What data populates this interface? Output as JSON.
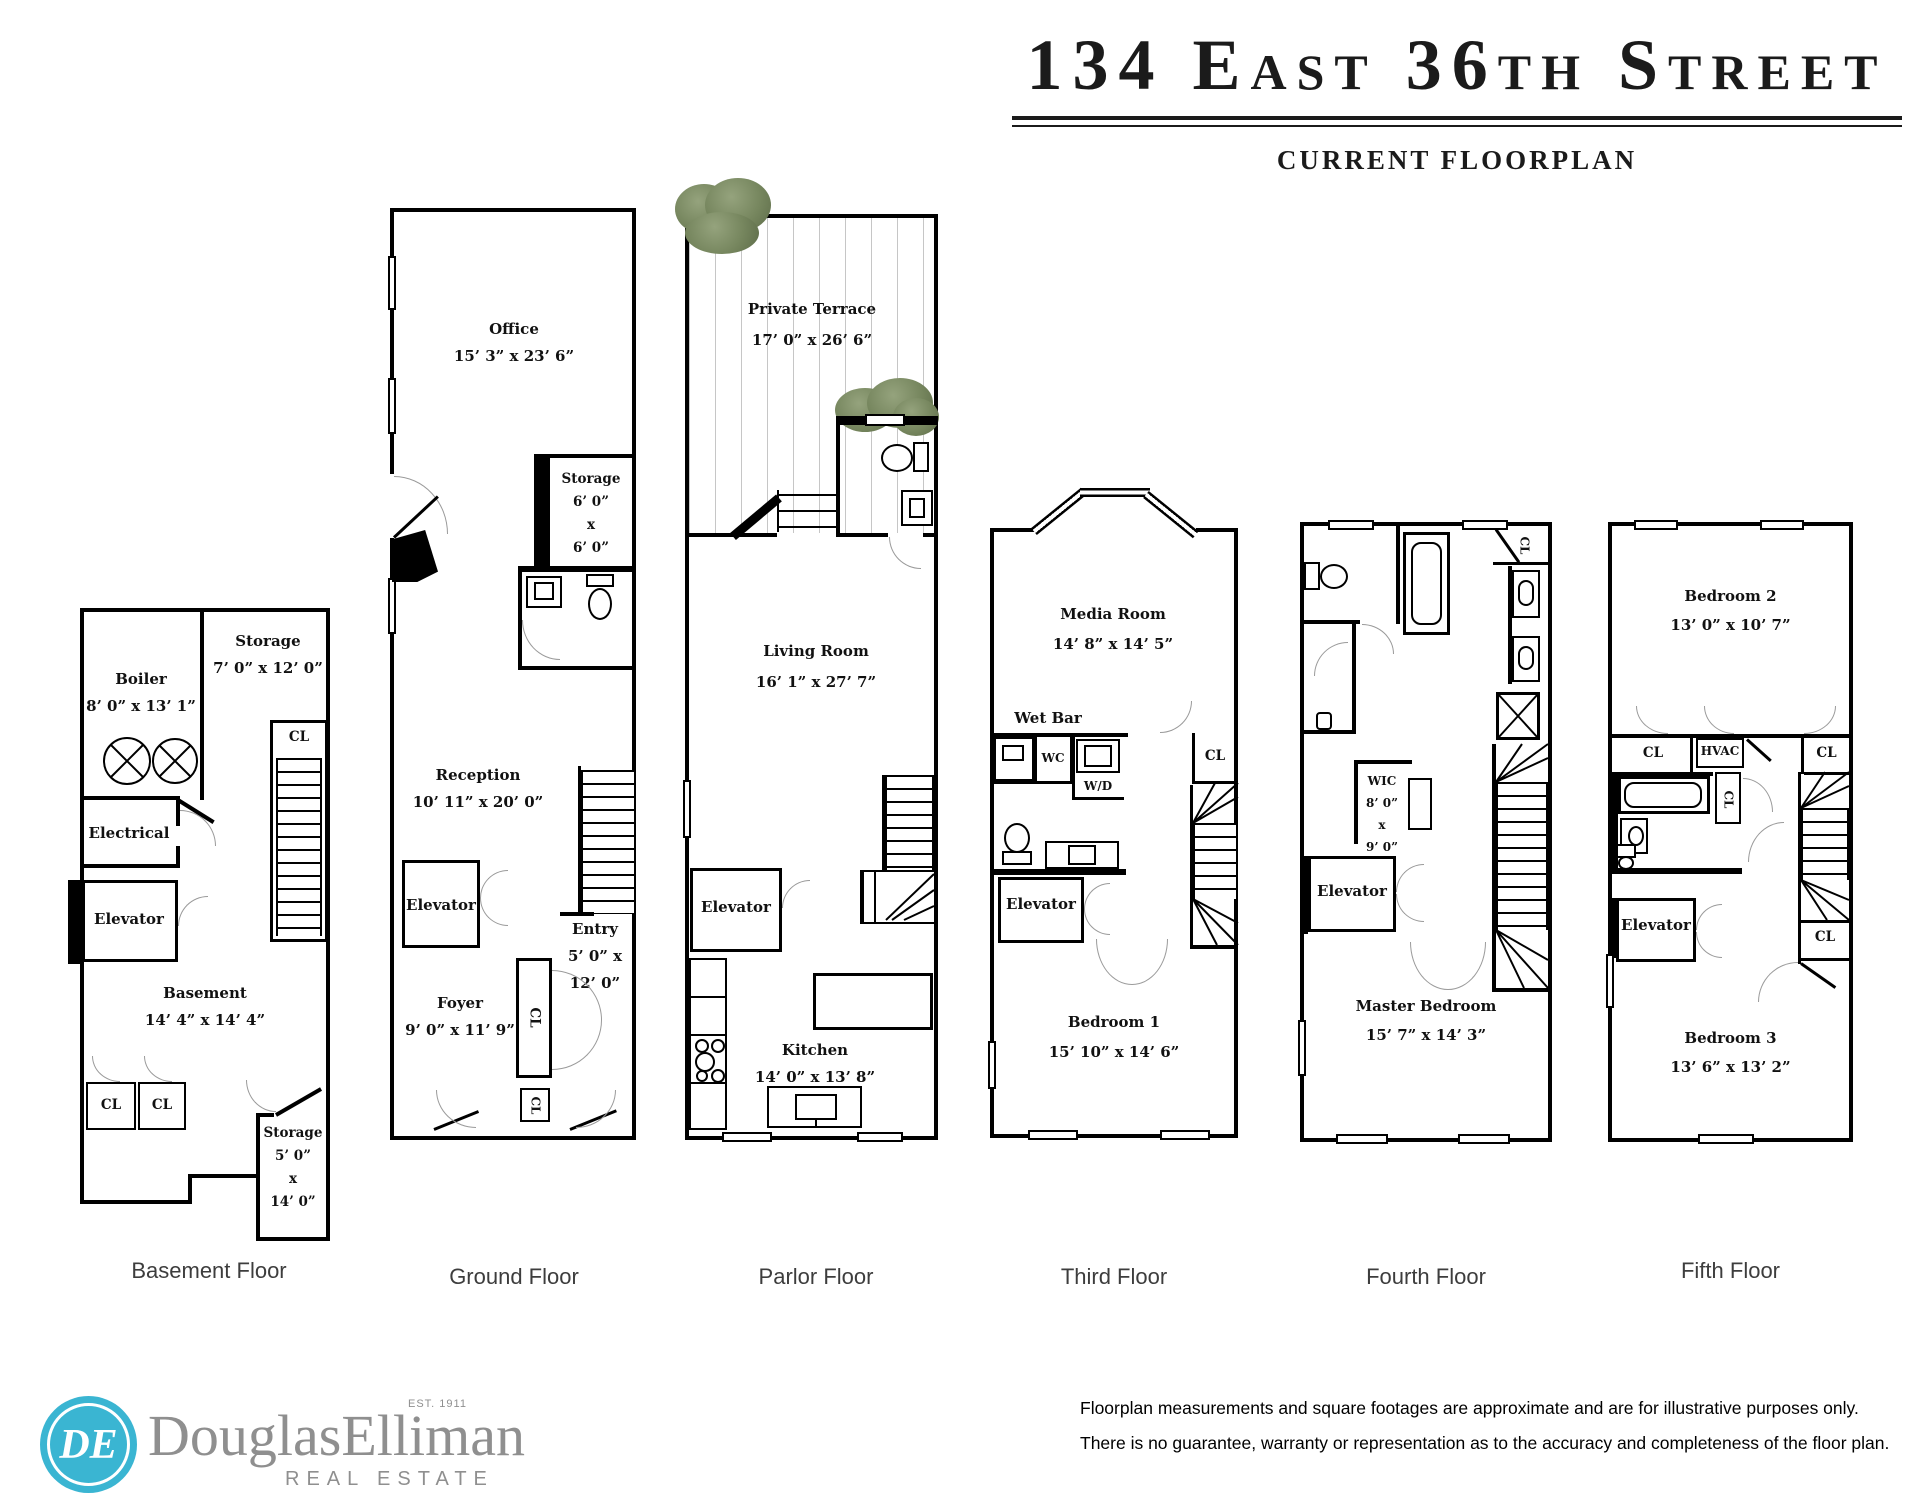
{
  "header": {
    "title": "134 East 36th Street",
    "subtitle": "CURRENT FLOORPLAN"
  },
  "floors": [
    {
      "label": "Basement Floor",
      "rooms": {
        "boiler": {
          "name": "Boiler",
          "dims": "8’ 0” x 13’ 1”"
        },
        "storage": {
          "name": "Storage",
          "dims": "7’ 0” x 12’ 0”"
        },
        "cl": "CL",
        "electrical": "Electrical",
        "elevator": "Elevator",
        "basement": {
          "name": "Basement",
          "dims": "14’ 4” x 14’ 4”"
        },
        "cl_a": "CL",
        "cl_b": "CL",
        "storage2": {
          "name": "Storage",
          "l1": "5’ 0”",
          "l2": "x",
          "l3": "14’ 0”"
        }
      }
    },
    {
      "label": "Ground Floor",
      "rooms": {
        "office": {
          "name": "Office",
          "dims": "15’ 3” x 23’ 6”"
        },
        "storage": {
          "name": "Storage",
          "l1": "6’ 0”",
          "l2": "x",
          "l3": "6’ 0”"
        },
        "reception": {
          "name": "Reception",
          "dims": "10’ 11” x 20’ 0”"
        },
        "elevator": "Elevator",
        "entry": {
          "name": "Entry",
          "l1": "5’ 0” x",
          "l2": "12’ 0”"
        },
        "foyer": {
          "name": "Foyer",
          "dims": "9’ 0” x 11’ 9”"
        },
        "cl_a": "CL",
        "cl_b": "CL"
      }
    },
    {
      "label": "Parlor Floor",
      "rooms": {
        "terrace": {
          "name": "Private Terrace",
          "dims": "17’ 0” x 26’ 6”"
        },
        "living": {
          "name": "Living Room",
          "dims": "16’ 1” x 27’ 7”"
        },
        "elevator": "Elevator",
        "kitchen": {
          "name": "Kitchen",
          "dims": "14’ 0” x 13’ 8”"
        }
      }
    },
    {
      "label": "Third Floor",
      "rooms": {
        "media": {
          "name": "Media Room",
          "dims": "14’ 8” x 14’ 5”"
        },
        "wetbar": "Wet Bar",
        "wc": "WC",
        "wd": "W/D",
        "cl": "CL",
        "elevator": "Elevator",
        "bedroom1": {
          "name": "Bedroom 1",
          "dims": "15’ 10” x 14’ 6”"
        }
      }
    },
    {
      "label": "Fourth Floor",
      "rooms": {
        "cl": "CL",
        "wic": {
          "name": "WIC",
          "l1": "8’ 0”",
          "l2": "x",
          "l3": "9’ 0”"
        },
        "elevator": "Elevator",
        "master": {
          "name": "Master Bedroom",
          "dims": "15’ 7” x 14’ 3”"
        }
      }
    },
    {
      "label": "Fifth Floor",
      "rooms": {
        "bedroom2": {
          "name": "Bedroom 2",
          "dims": "13’ 0” x 10’ 7”"
        },
        "cl_a": "CL",
        "hvac": "HVAC",
        "cl_b": "CL",
        "cl_c": "CL",
        "elevator": "Elevator",
        "cl_d": "CL",
        "bedroom3": {
          "name": "Bedroom 3",
          "dims": "13’ 6” x 13’ 2”"
        }
      }
    }
  ],
  "footer": {
    "logo": {
      "monogram": "DE",
      "brand": "DouglasElliman",
      "est": "EST. 1911",
      "tagline": "REAL ESTATE"
    },
    "disclaimer_line1": "Floorplan measurements and square footages are approximate and are for illustrative purposes only.",
    "disclaimer_line2": "There is no guarantee, warranty or representation as to the accuracy and completeness of the floor plan."
  },
  "colors": {
    "wall": "#000000",
    "accent_teal": "#3ab5d2",
    "brand_gray": "#8f8f8f",
    "bush_green": "#76865e"
  }
}
